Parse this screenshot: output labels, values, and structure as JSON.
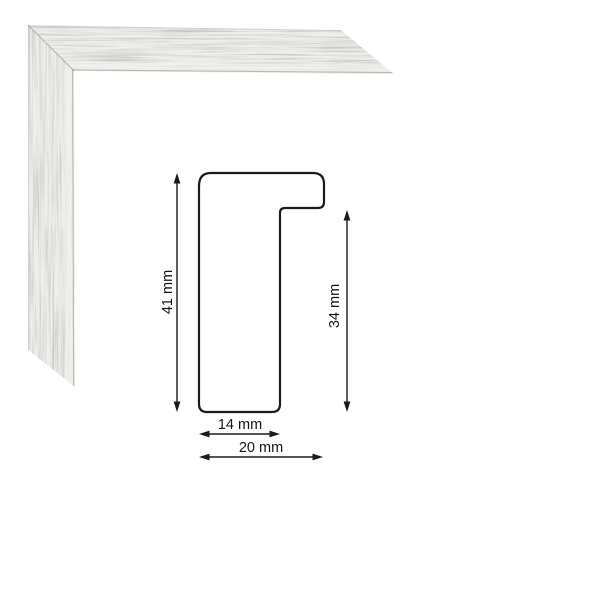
{
  "image": {
    "background_color": "#ffffff",
    "photo": {
      "subject": "frame-corner-sample-photo",
      "finish": "distressed-silver-white",
      "base_color": "#efeeeb",
      "streak_color": "#6b6b66"
    },
    "diagram": {
      "outline_color": "#1b1b1b",
      "profile_dimensions": {
        "overall_height_mm": 41,
        "inner_height_mm": 34,
        "inner_width_mm": 14,
        "overall_width_mm": 20
      },
      "labels": {
        "overall_height": "41 mm",
        "inner_height": "34 mm",
        "inner_width": "14 mm",
        "overall_width": "20 mm"
      }
    }
  }
}
